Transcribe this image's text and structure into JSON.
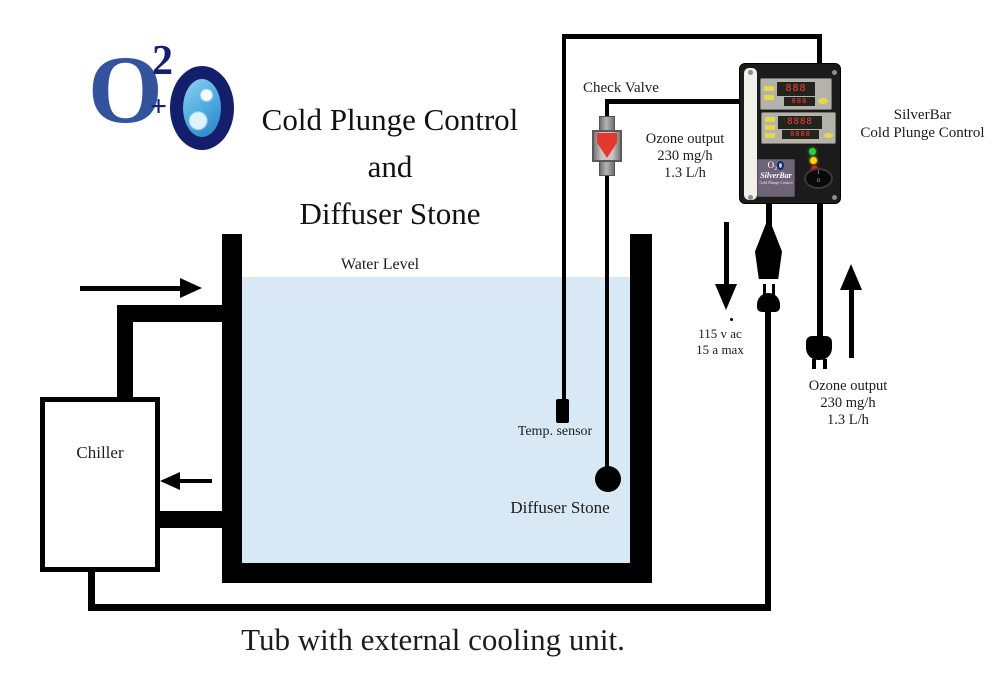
{
  "logo": {
    "o": "O",
    "exp": "2",
    "plus": "+"
  },
  "title": {
    "line1": "Cold Plunge Control",
    "line2": "and",
    "line3": "Diffuser Stone"
  },
  "tub": {
    "water_level": "Water Level",
    "caption": "Tub with external cooling unit."
  },
  "chiller": {
    "label": "Chiller"
  },
  "sensor": {
    "label": "Temp. sensor"
  },
  "diffuser": {
    "label": "Diffuser Stone"
  },
  "valve": {
    "label": "Check Valve"
  },
  "ozone_upper": {
    "l1": "Ozone output",
    "l2": "230 mg/h",
    "l3": "1.3 L/h"
  },
  "ozone_lower": {
    "l1": "Ozone output",
    "l2": "230 mg/h",
    "l3": "1.3 L/h"
  },
  "power": {
    "l1": "115 v ac",
    "l2": "15 a max"
  },
  "unit_caption": {
    "l1": "SilverBar",
    "l2": "Cold Plunge Control"
  },
  "control_unit": {
    "display1_row1": "888",
    "display1_row2": "888",
    "display2_row1": "8888",
    "display2_row2": "8888",
    "brand_logo": "O₂",
    "brand": "SilverBar",
    "brand_sub": "Cold Plunge Control",
    "switch_on": "I",
    "switch_off": "O"
  },
  "colors": {
    "water": "#d8e8f4",
    "line": "#000000",
    "valve_red": "#e5382c",
    "led_green": "#2ecc3a",
    "led_yellow": "#ffd500",
    "led_red": "#ee2222",
    "logo_blue": "#33539c",
    "logo_navy": "#131f6b",
    "brand_label_purple": "#6e6377"
  }
}
